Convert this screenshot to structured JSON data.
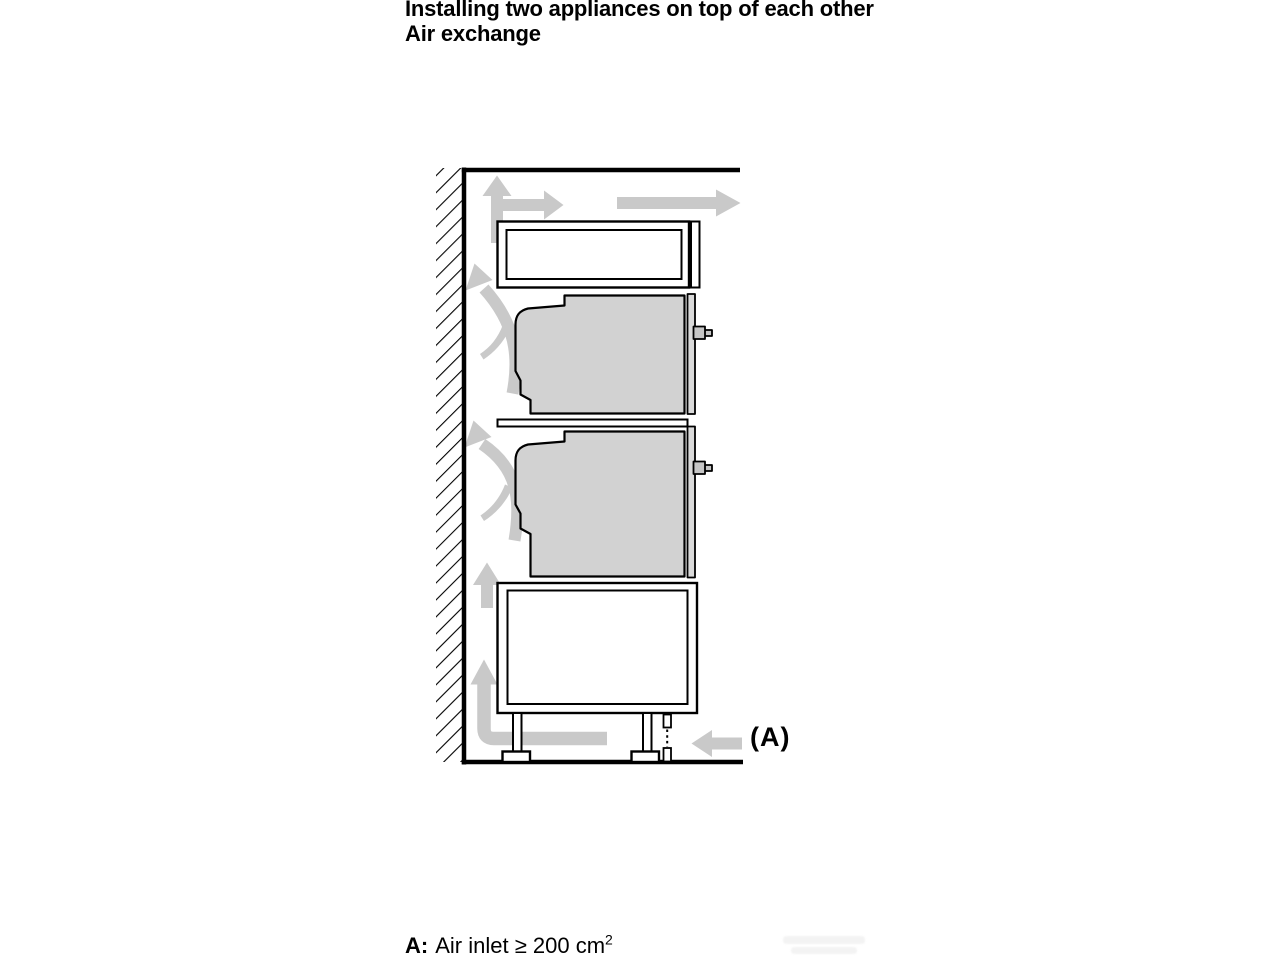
{
  "header": {
    "title": "Installing two appliances on top of each other",
    "subtitle": "Air exchange"
  },
  "diagram": {
    "label_a": "(A)",
    "colors": {
      "line": "#000000",
      "appliance_fill": "#d2d2d2",
      "door_fill": "#dadada",
      "handle_fill": "#c6c6c6",
      "arrow": "#c9c9c9",
      "background": "#ffffff"
    }
  },
  "caption": {
    "prefix": "A:",
    "text": "Air inlet ≥ 200 cm",
    "superscript": "2"
  }
}
